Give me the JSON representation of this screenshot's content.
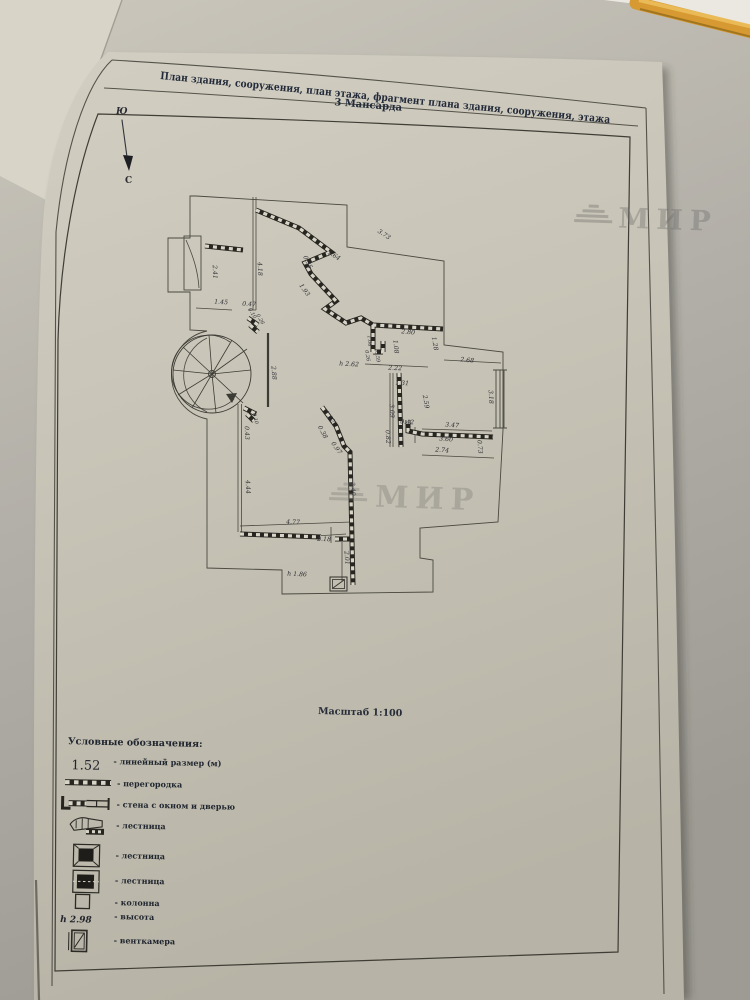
{
  "document": {
    "title_row": "План здания, сооружения, план этажа, фрагмент плана здания, сооружения, этажа",
    "floor_row": "3 Мансарда",
    "scale_label": "Масштаб 1:100",
    "watermark_text": "МИР"
  },
  "compass": {
    "south_label": "Ю",
    "north_label": "С"
  },
  "plan": {
    "dims": [
      "3.73",
      "1.64",
      "0.35",
      "1.93",
      "4.18",
      "2.41",
      "1.45",
      "0.47",
      "2.80",
      "1.08",
      "1.28",
      "2.68",
      "h 2.62",
      "2.22",
      "1.31",
      "3.18",
      "3.09",
      "2.59",
      "0.42",
      "0.82",
      "3.47",
      "3.60",
      "2.74",
      "0.73",
      "1.62",
      "0.38",
      "0.97",
      "3.40",
      "4.44",
      "0.43",
      "4.77",
      "2.18",
      "2.01",
      "h 1.86",
      "0.26",
      "0.59",
      "1.06",
      "2.88",
      "0.26",
      "0.10",
      "0.10"
    ]
  },
  "legend": {
    "header": "Условные обозначения:",
    "items": [
      {
        "icon": "linear-size-sample",
        "sample": "1.52",
        "label": "- линейный размер (м)"
      },
      {
        "icon": "partition-icon",
        "label": "- перегородка"
      },
      {
        "icon": "wall-window-door-icon",
        "label": "- стена с окном и дверью"
      },
      {
        "icon": "stairs-icon",
        "label": "- лестница"
      },
      {
        "icon": "stairs-icon",
        "label": "- лестница"
      },
      {
        "icon": "stairs-icon",
        "label": "- лестница"
      },
      {
        "icon": "column-icon",
        "label": "- колонна"
      },
      {
        "icon": "height-sample",
        "sample": "h 2.98",
        "label": "- высота"
      },
      {
        "icon": "vent-chamber-icon",
        "label": "- венткамера"
      }
    ]
  },
  "colors": {
    "paper": "#c9c5b9",
    "desk": "#b2afa8",
    "ink": "#44423c",
    "title_ink": "#232b3a",
    "pencil": "#dd9f3a",
    "watermark": "#6f6e6c"
  }
}
